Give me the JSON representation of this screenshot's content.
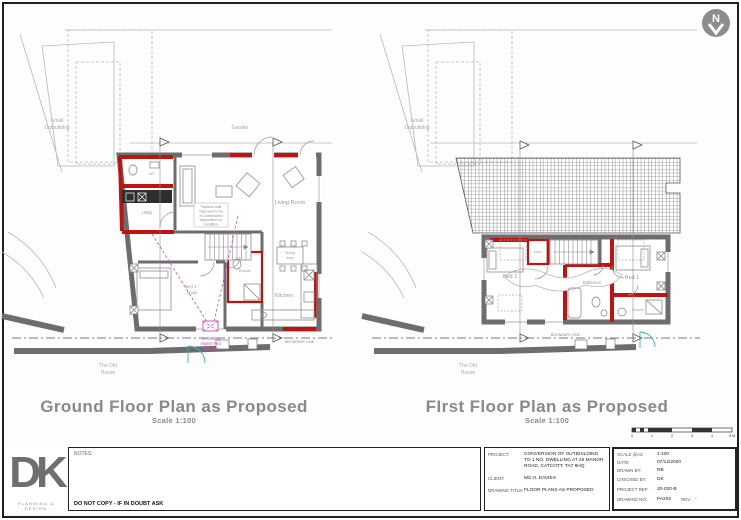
{
  "sheet": {
    "north_label": "N"
  },
  "ground": {
    "title": "Ground Floor Plan as Proposed",
    "scale_note": "Scale 1:100",
    "rooms": {
      "wc": "WC",
      "utility": "Utility",
      "living_room": "Living Room",
      "bed3_line1": "Bed 3 /",
      "bed3_line2": "Study",
      "ensuite": "Ensuite",
      "kitchen": "Kitchen",
      "dining_line1": "Dining",
      "dining_line2": "Area"
    },
    "context": {
      "small_outbuilding_line1": "Small",
      "small_outbuilding_line2": "Outbuilding",
      "garden": "Garden",
      "old_house_line1": "The Old",
      "old_house_line2": "House",
      "boundary_line": "BOUNDARY LINE"
    },
    "notes": {
      "partition_line1": "Partition wall",
      "partition_line2": "may need to be",
      "partition_line3": "re-constructed",
      "partition_line4": "dependent on",
      "partition_line5": "condition",
      "smoke_line1": "1x Ceiling",
      "smoke_line2": "Mains Fed",
      "smoke_line3": "Detector"
    }
  },
  "first": {
    "title": "FIrst Floor Plan as Proposed",
    "scale_note": "Scale 1:100",
    "rooms": {
      "bed1": "Bed 1",
      "bed2": "Bed 2",
      "bathroom": "Bathroom",
      "ensuite": "Ensuite",
      "linen": "Linen"
    },
    "context": {
      "small_outbuilding_line1": "Small",
      "small_outbuilding_line2": "Outbuilding",
      "old_house_line1": "The Old",
      "old_house_line2": "House",
      "boundary_line": "BOUNDARY LINE"
    }
  },
  "scale_bar": {
    "ticks": [
      "0",
      "1",
      "2",
      "3",
      "4",
      "5 M"
    ]
  },
  "title_block": {
    "logo_letters": "DK",
    "logo_tagline": "PLANNING & DESIGN",
    "notes_label": "NOTES:",
    "do_not_copy": "DO NOT COPY - IF IN DOUBT ASK",
    "fields": [
      {
        "label": "PROJECT:",
        "value": "CONVERSION OF OUTBUILDING TO 1 NO. DWELLING AT 25 MANOR ROAD, CATCOTT, TA7 9HQ"
      },
      {
        "label": "CLIENT:",
        "value": "MS H. DAVIES"
      },
      {
        "label": "DRAWING TITLE:",
        "value": "FLOOR PLANS AS PROPOSED"
      }
    ],
    "meta": [
      {
        "label": "SCALE @A3:",
        "value": "1:100"
      },
      {
        "label": "DATE:",
        "value": "07/12/2020"
      },
      {
        "label": "DRAWN BY:",
        "value": "RB"
      },
      {
        "label": "CHECKED BY:",
        "value": "DK"
      },
      {
        "label": "PROJECT REF:",
        "value": "20-020-B"
      },
      {
        "label": "DRAWING No:",
        "value": "PA202"
      },
      {
        "label": "REV:",
        "value": "-"
      }
    ]
  }
}
